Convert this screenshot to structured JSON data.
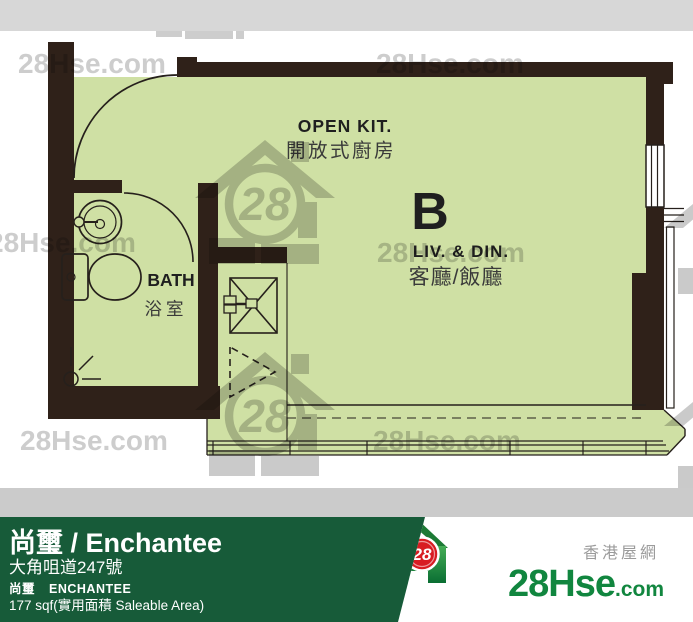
{
  "plan": {
    "unit_label": "B",
    "kitchen": {
      "en": "OPEN KIT.",
      "zh": "開放式廚房"
    },
    "living": {
      "en": "LIV. & DIN.",
      "zh": "客廳/飯廳"
    },
    "bath": {
      "en": "BATH",
      "zh": "浴室"
    }
  },
  "watermark": {
    "text": "28Hse.com",
    "badge": "28"
  },
  "footer": {
    "title": "尚璽 / Enchantee",
    "address": "大角咀道247號",
    "name_zh": "尚璽",
    "name_en": "ENCHANTEE",
    "area": "177 sqf(實用面積 Saleable Area)"
  },
  "brand": {
    "tagline": "香港屋網",
    "badge": "28",
    "name_main": "28Hse",
    "name_suffix": ".com"
  },
  "colors": {
    "floor_green": "#cfe0a4",
    "wall_dark": "#2f2119",
    "top_band_gray": "#d7d7d7",
    "divider_gray": "#cbcbcb",
    "footer_green": "#175b39",
    "logo_red": "#d81c22",
    "logo_green": "#11863f",
    "watermark_gray": "#c8c8c8"
  }
}
